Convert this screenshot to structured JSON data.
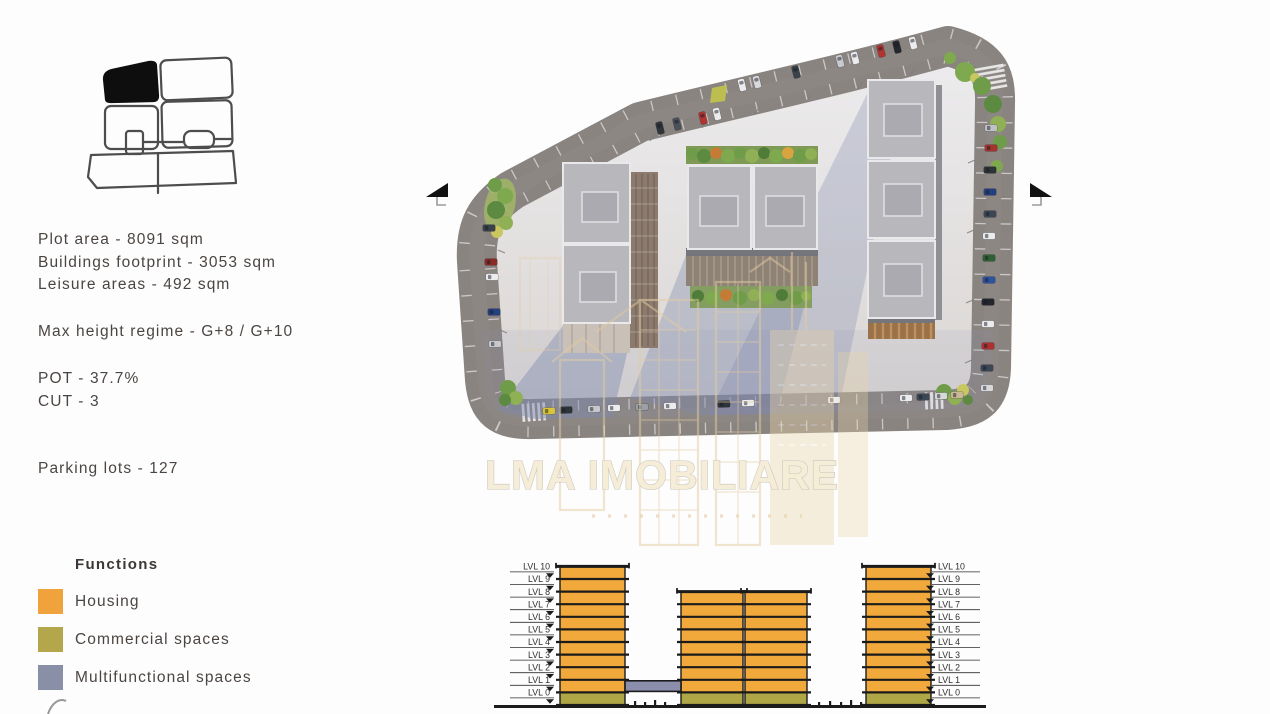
{
  "stats": {
    "lines": [
      "Plot area - 8091 sqm",
      "Buildings footprint - 3053 sqm",
      "Leisure areas - 492 sqm",
      "Max height regime - G+8 / G+10",
      "POT - 37.7%",
      "CUT - 3",
      "Parking lots - 127"
    ]
  },
  "legend": {
    "title": "Functions",
    "items": [
      {
        "label": "Housing",
        "color": "#F0A23C"
      },
      {
        "label": "Commercial spaces",
        "color": "#B4A74B"
      },
      {
        "label": "Multifunctional spaces",
        "color": "#8A8FA8"
      }
    ]
  },
  "watermark": {
    "text": "LMA IMOBILIARE",
    "color": "#F5EDD6"
  },
  "render_palette": {
    "road": "#8A8481",
    "plaza_light": "#EDECEE",
    "plaza_dark": "#D8D4D1",
    "roof": "#B8B7BC",
    "shadow": "#7D88AD",
    "greenery": "#6E9C49"
  },
  "section": {
    "levels": [
      "LVL 10",
      "LVL 9",
      "LVL 8",
      "LVL 7",
      "LVL 6",
      "LVL 5",
      "LVL 4",
      "LVL 3",
      "LVL 2",
      "LVL 1",
      "LVL 0"
    ],
    "colors": {
      "housing": "#F2A93B",
      "commercial": "#AFA646",
      "multifunctional": "#8B8FAC"
    },
    "towers": [
      {
        "name": "left-tower",
        "x": 72,
        "w": 65,
        "floors": 11,
        "top_level": "LVL 10"
      },
      {
        "name": "mid-tower-a",
        "x": 193,
        "w": 62,
        "floors": 9,
        "top_level": "LVL 8"
      },
      {
        "name": "mid-tower-b",
        "x": 257,
        "w": 62,
        "floors": 9,
        "top_level": "LVL 8"
      },
      {
        "name": "right-tower",
        "x": 378,
        "w": 65,
        "floors": 11,
        "top_level": "LVL 10"
      }
    ],
    "bridge": {
      "x": 137,
      "w": 56,
      "level": 1,
      "function": "multifunctional"
    }
  }
}
